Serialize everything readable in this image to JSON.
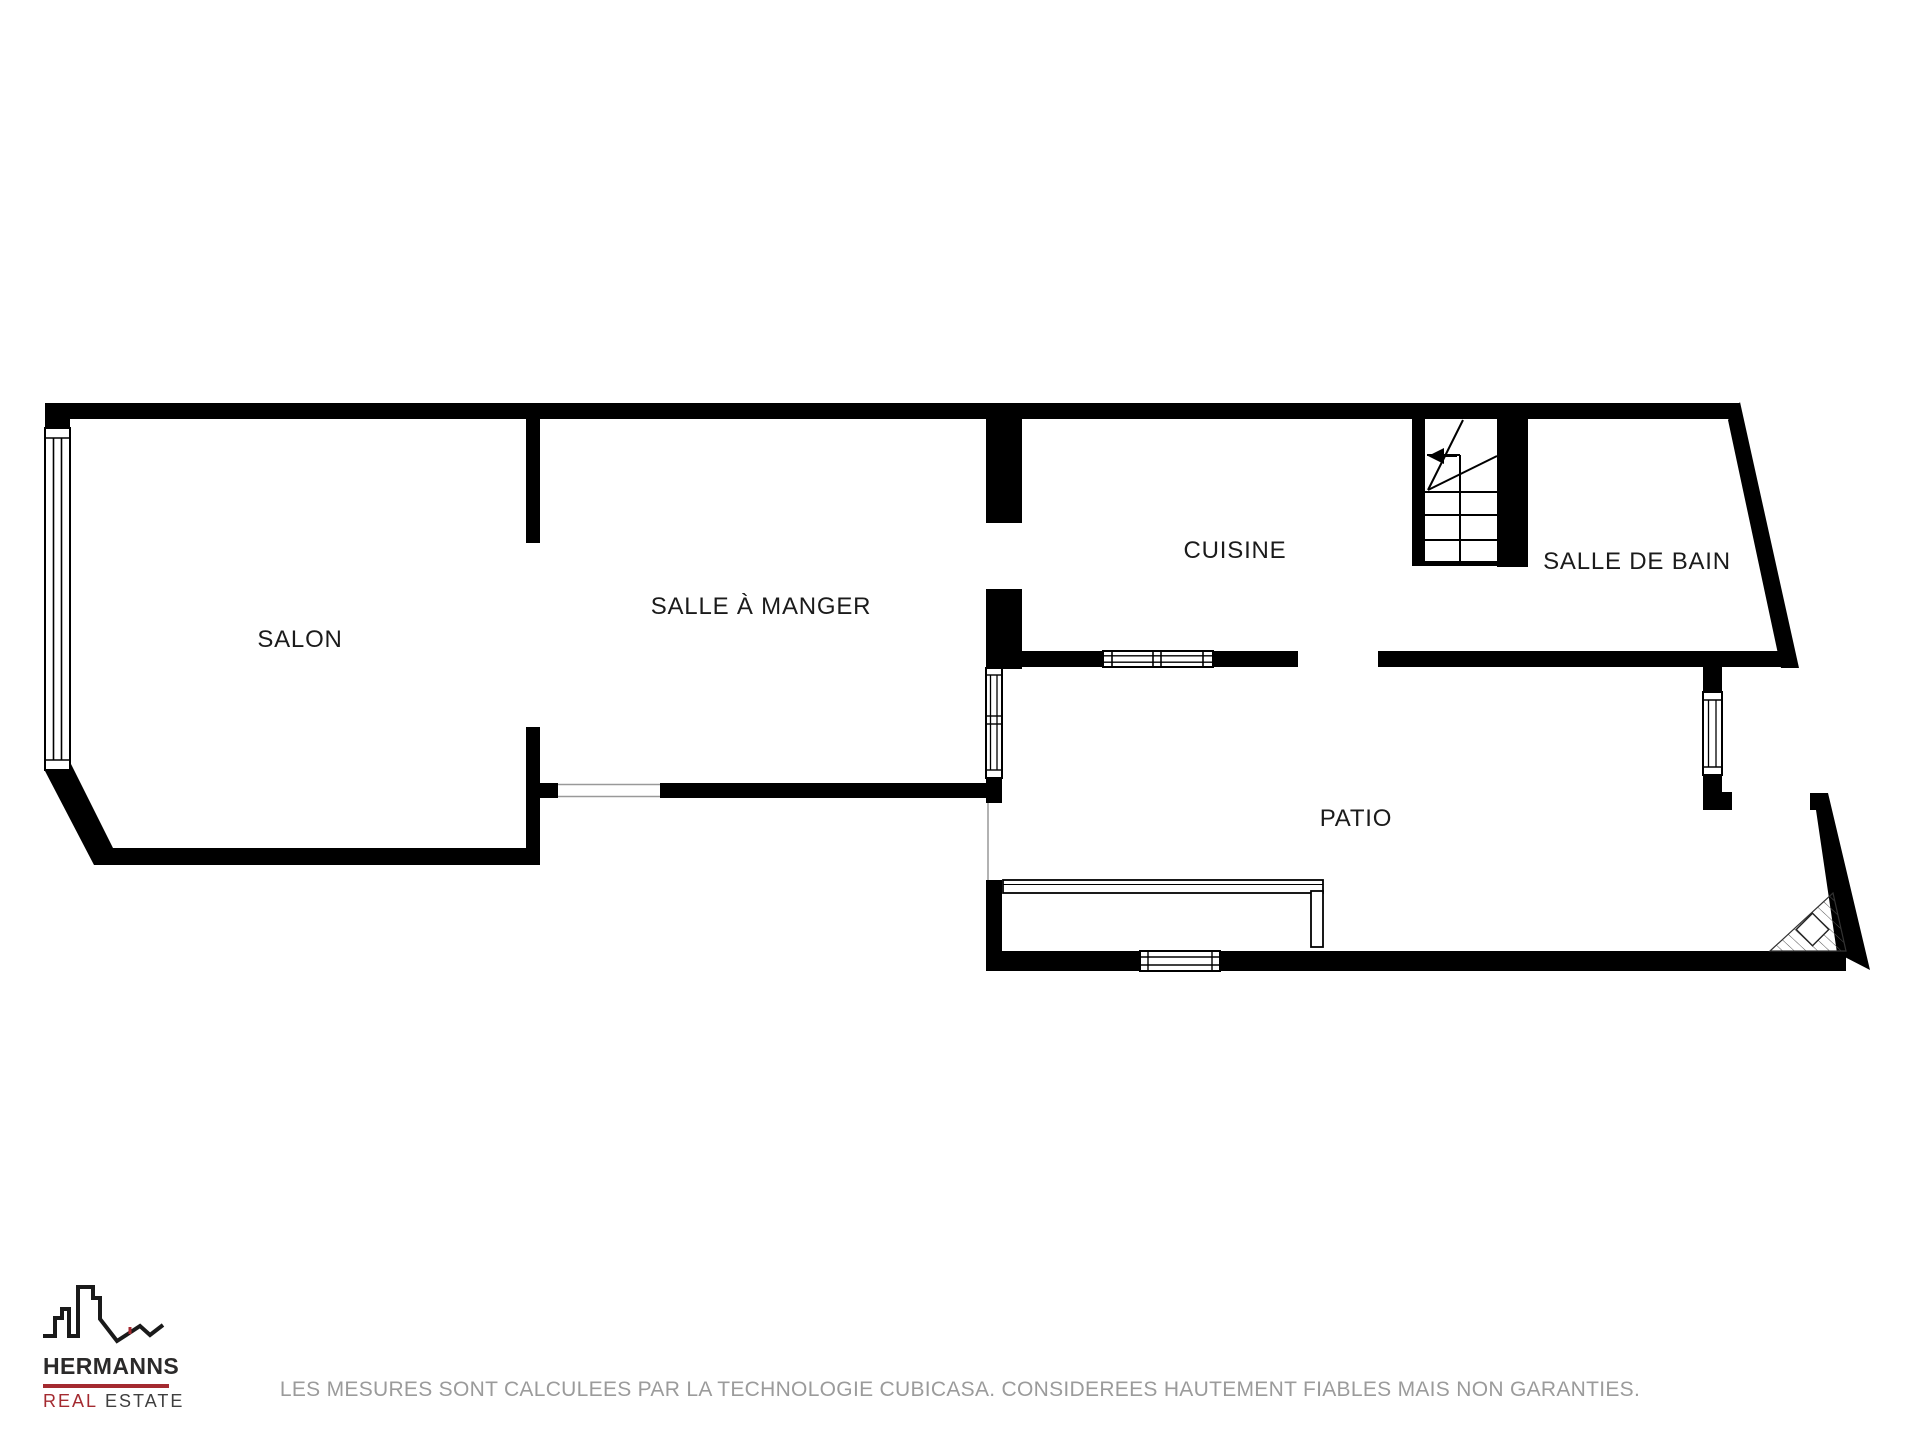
{
  "floorplan": {
    "wall_color": "#000000",
    "label_color": "#1b1b1b",
    "rooms": [
      {
        "id": "salon",
        "label": "SALON"
      },
      {
        "id": "salle-a-manger",
        "label": "SALLE À MANGER"
      },
      {
        "id": "cuisine",
        "label": "CUISINE"
      },
      {
        "id": "salle-de-bain",
        "label": "SALLE DE BAIN"
      },
      {
        "id": "patio",
        "label": "PATIO"
      }
    ],
    "features": [
      "stairs-winder-icon",
      "window-symbols",
      "door-openings",
      "hatched-corner"
    ]
  },
  "branding": {
    "icon": "city-skyline-icon",
    "name": "HERMANNS",
    "tagline_primary": "REAL",
    "tagline_secondary": "ESTATE",
    "accent_color": "#a42a30",
    "text_color": "#2b2a2a"
  },
  "footer": {
    "disclaimer": "LES MESURES SONT CALCULEES PAR LA TECHNOLOGIE CUBICASA. CONSIDEREES HAUTEMENT FIABLES MAIS NON GARANTIES.",
    "color": "#9b9b9b"
  }
}
